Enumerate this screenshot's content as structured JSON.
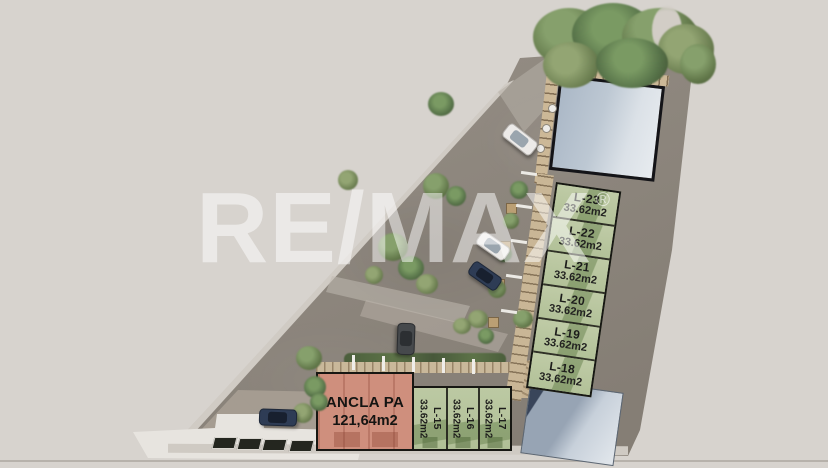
{
  "watermark": {
    "brand": "RE/MAX",
    "registered_mark": "®"
  },
  "plan": {
    "anchor_unit": {
      "label": "ANCLA PA",
      "area": "121,64m2"
    },
    "column_units": [
      {
        "label": "L-23",
        "area": "33.62m2"
      },
      {
        "label": "L-22",
        "area": "33.62m2"
      },
      {
        "label": "L-21",
        "area": "33.62m2"
      },
      {
        "label": "L-20",
        "area": "33.62m2"
      },
      {
        "label": "L-19",
        "area": "33.62m2"
      },
      {
        "label": "L-18",
        "area": "33.62m2"
      }
    ],
    "row_units": [
      {
        "label": "L-15",
        "area": "33.62m2"
      },
      {
        "label": "L-16",
        "area": "33.62m2"
      },
      {
        "label": "L-17",
        "area": "33.62m2"
      }
    ]
  },
  "colors": {
    "background": "#d7d3ce",
    "pavement": "#8e877e",
    "lot_green": "#b9c6a0",
    "lot_green_dark": "#627c46",
    "anchor_salmon": "#cf8f7d",
    "roof_blue": "#c3ccd6",
    "wood_pergola": "#c9b696",
    "outline_black": "#171713",
    "tree_green": "#63794b",
    "watermark_white": "rgba(255,255,255,0.5)"
  }
}
